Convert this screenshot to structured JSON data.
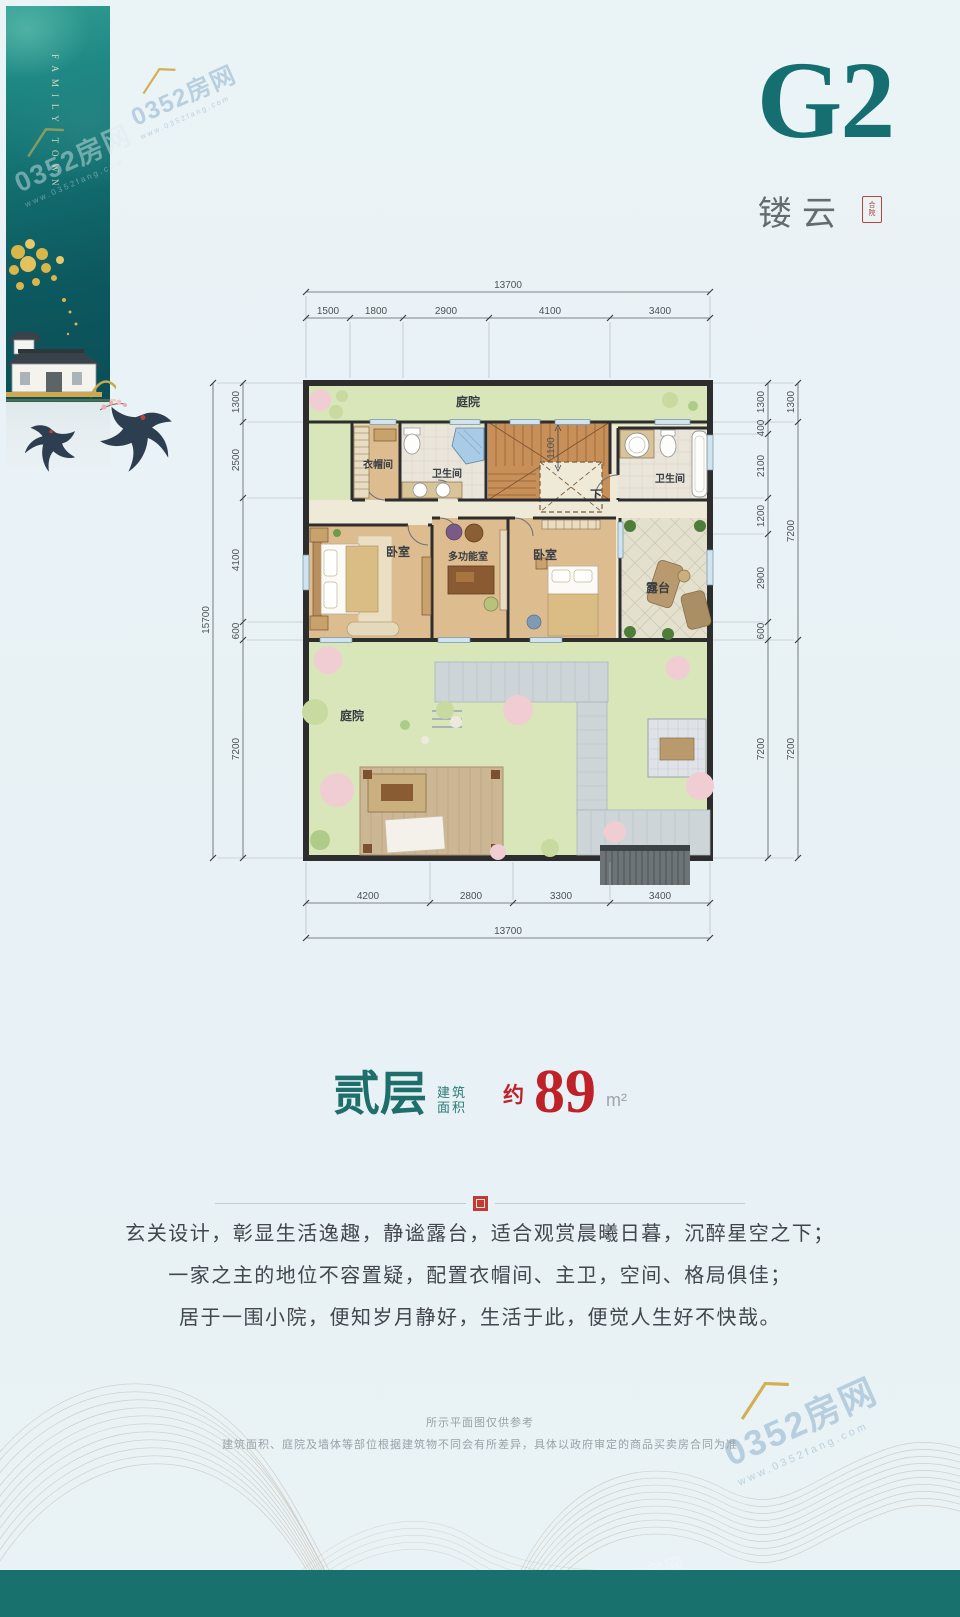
{
  "page": {
    "background": "#e9f1f5",
    "accent_teal": "#156f70",
    "accent_red": "#bf2128",
    "footer_color": "#19716d"
  },
  "banner": {
    "title": "FAMILY TOWN"
  },
  "watermark": {
    "brand": "0352房网",
    "url": "www.0352fang.com"
  },
  "header": {
    "unit": "G2",
    "name": "镂云",
    "seal_top": "合",
    "seal_bottom": "院"
  },
  "plan": {
    "rooms": {
      "courtyard_top": "庭院",
      "cloakroom": "衣帽间",
      "bathroom_left": "卫生间",
      "bathroom_right": "卫生间",
      "bedroom_left": "卧室",
      "multi_room": "多功能室",
      "bedroom_right": "卧室",
      "terrace": "露台",
      "courtyard_bottom": "庭院",
      "stairs_down": "下"
    },
    "dims": {
      "top_total": "13700",
      "top_segments": [
        "1500",
        "1800",
        "2900",
        "4100",
        "3400"
      ],
      "left_total": "15700",
      "left_segments": [
        "1300",
        "2500",
        "4100",
        "600",
        "7200"
      ],
      "right_inner_segments": [
        "1300",
        "400",
        "2100",
        "1200",
        "2900",
        "600",
        "7200"
      ],
      "right_outer_segments": [
        "1300",
        "7200",
        "7200"
      ],
      "bottom_segments": [
        "4200",
        "2800",
        "3300",
        "3400"
      ],
      "bottom_total": "13700",
      "stair_width": "1100"
    }
  },
  "area": {
    "floor": "贰层",
    "label_top": "建筑",
    "label_bottom": "面积",
    "approx": "约",
    "value": "89",
    "unit": "m²"
  },
  "description": {
    "lines": [
      "玄关设计，彰显生活逸趣，静谧露台，适合观赏晨曦日暮，沉醉星空之下；",
      "一家之主的地位不容置疑，配置衣帽间、主卫，空间、格局俱佳；",
      "居于一围小院，便知岁月静好，生活于此，便觉人生好不快哉。"
    ]
  },
  "disclaimer": {
    "lines": [
      "所示平面图仅供参考",
      "建筑面积、庭院及墙体等部位根据建筑物不同会有所差异，具体以政府审定的商品买卖房合同为准"
    ]
  }
}
